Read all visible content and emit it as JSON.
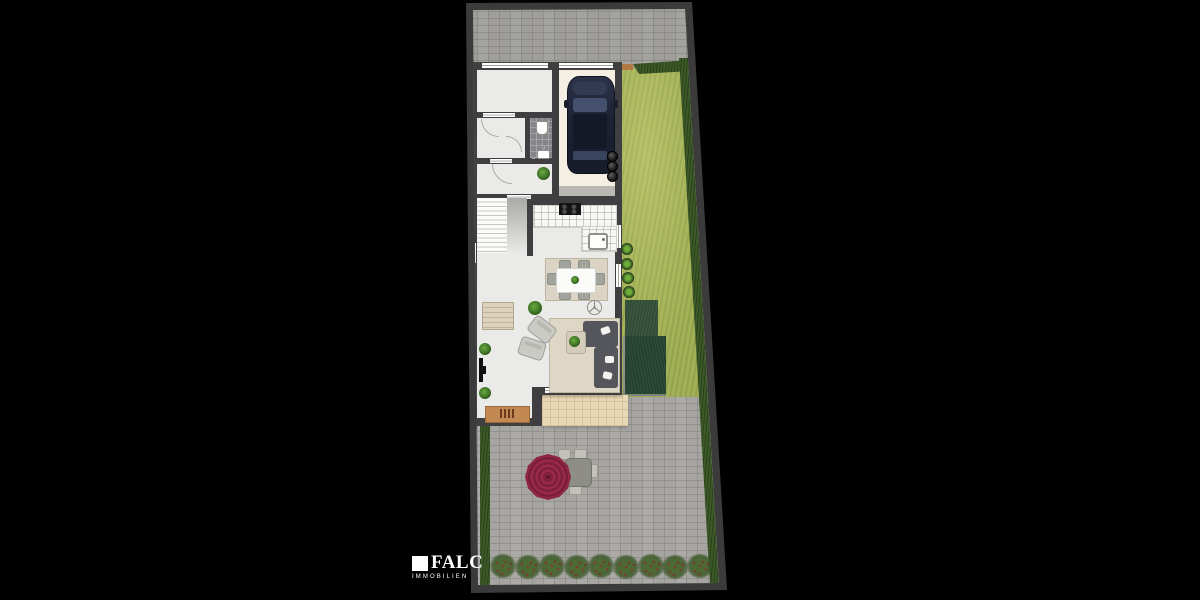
{
  "branding": {
    "name": "FALC",
    "tagline": "IMMOBILIEN"
  },
  "colors": {
    "bg": "#000000",
    "border": "#3b3b3b",
    "pavement": "#a6a5a1",
    "lawn": "#a3b156",
    "hedge": "#3c5a28",
    "sheda": "#3a5640",
    "shedb": "#2c4a38",
    "wall": "#3f3f41",
    "floor": "#eaeae8",
    "carport": "#f4efe2",
    "terrace": "#ead9b6",
    "rug": "#dbd3c3",
    "sofa": "#54565c",
    "wood": "#c28a52",
    "parasol": "#99294a",
    "car": "#222838",
    "rose": "#a11f2e"
  },
  "plan": {
    "counts": {
      "rose_bushes": 9,
      "waste_bins": 3,
      "potted_plants": 4,
      "dining_chairs": 6,
      "patio_chairs": 4
    }
  }
}
